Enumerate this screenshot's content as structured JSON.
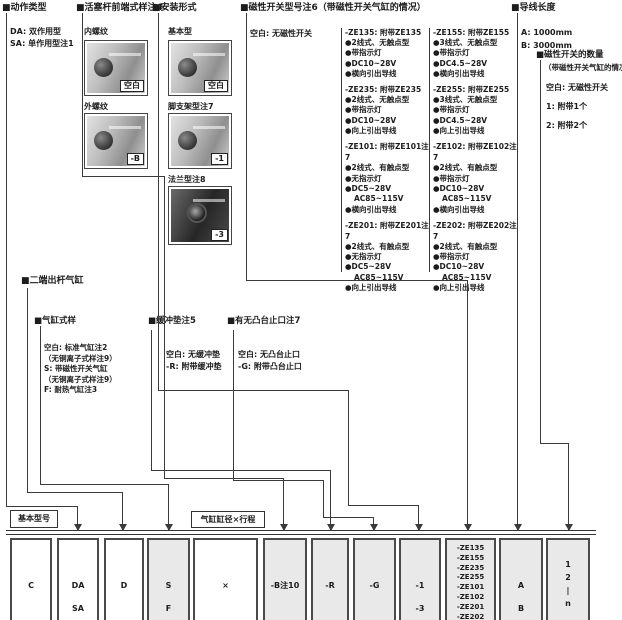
{
  "sections": {
    "action_type": {
      "title": "■动作类型",
      "items": [
        "DA: 双作用型",
        "SA: 单作用型注1"
      ]
    },
    "rod_end": {
      "title": "■活塞杆前端式样注4",
      "variants": [
        {
          "label": "内螺纹",
          "code": "空白"
        },
        {
          "label": "外螺纹",
          "code": "-B"
        }
      ]
    },
    "mounting": {
      "title": "■安装形式",
      "variants": [
        {
          "label": "基本型",
          "code": "空白"
        },
        {
          "label": "脚支架型注7",
          "code": "-1"
        },
        {
          "label": "法兰型注8",
          "code": "-3"
        }
      ]
    },
    "switch_model": {
      "title": "■磁性开关型号注6（带磁性开关气缸的情况）",
      "blank": "空白: 无磁性开关",
      "col_left": [
        {
          "head": "-ZE135: 附带ZE135",
          "bullets": [
            "●2线式、无触点型",
            "●带指示灯",
            "●DC10~28V",
            "●横向引出导线"
          ]
        },
        {
          "head": "-ZE235: 附带ZE235",
          "bullets": [
            "●2线式、无触点型",
            "●带指示灯",
            "●DC10~28V",
            "●向上引出导线"
          ]
        },
        {
          "head": "-ZE101: 附带ZE101注7",
          "bullets": [
            "●2线式、有触点型",
            "●无指示灯",
            "●DC5~28V",
            "AC85~115V",
            "●横向引出导线"
          ]
        },
        {
          "head": "-ZE201: 附带ZE201注7",
          "bullets": [
            "●2线式、有触点型",
            "●无指示灯",
            "●DC5~28V",
            "AC85~115V",
            "●向上引出导线"
          ]
        }
      ],
      "col_right": [
        {
          "head": "-ZE155: 附带ZE155",
          "bullets": [
            "●3线式、无触点型",
            "●带指示灯",
            "●DC4.5~28V",
            "●横向引出导线"
          ]
        },
        {
          "head": "-ZE255: 附带ZE255",
          "bullets": [
            "●3线式、无触点型",
            "●带指示灯",
            "●DC4.5~28V",
            "●向上引出导线"
          ]
        },
        {
          "head": "-ZE102: 附带ZE102注7",
          "bullets": [
            "●2线式、有触点型",
            "●带指示灯",
            "●DC10~28V",
            "AC85~115V",
            "●横向引出导线"
          ]
        },
        {
          "head": "-ZE202: 附带ZE202注7",
          "bullets": [
            "●2线式、有触点型",
            "●带指示灯",
            "●DC10~28V",
            "AC85~115V",
            "●向上引出导线"
          ]
        }
      ]
    },
    "lead_length": {
      "title": "■导线长度",
      "items": [
        "A: 1000mm",
        "B: 3000mm"
      ]
    },
    "switch_qty": {
      "title": "■磁性开关的数量",
      "subtitle": "（带磁性开关气缸的情况）",
      "items": [
        "空白: 无磁性开关",
        "1: 附带1个",
        "2: 附带2个"
      ]
    },
    "double_rod": {
      "title": "■二端出杆气缸"
    },
    "cyl_style": {
      "title": "■气缸式样",
      "lines": [
        "空白: 标准气缸注2",
        "（无铜离子式样注9）",
        "S: 带磁性开关气缸",
        "（无铜离子式样注9）",
        "F: 耐热气缸注3"
      ]
    },
    "cushion": {
      "title": "■缓冲垫注5",
      "lines": [
        "空白: 无缓冲垫",
        "-R: 附带缓冲垫"
      ]
    },
    "boss": {
      "title": "■有无凸台止口注7",
      "lines": [
        "空白: 无凸台止口",
        "-G: 附带凸台止口"
      ]
    }
  },
  "bottom": {
    "base_label": "基本型号",
    "bore_label": "气缸缸径×行程",
    "boxes": [
      [
        "C"
      ],
      [
        "DA",
        "SA"
      ],
      [
        "D"
      ],
      [
        "S",
        "F"
      ],
      [
        "×"
      ],
      [
        "-B注10"
      ],
      [
        "-R"
      ],
      [
        "-G"
      ],
      [
        "-1",
        "-3"
      ],
      [
        "-ZE135",
        "-ZE155",
        "-ZE235",
        "-ZE255",
        "-ZE101",
        "-ZE102",
        "-ZE201",
        "-ZE202"
      ],
      [
        "A",
        "B"
      ],
      [
        "1",
        "2",
        "|",
        "n"
      ]
    ]
  }
}
